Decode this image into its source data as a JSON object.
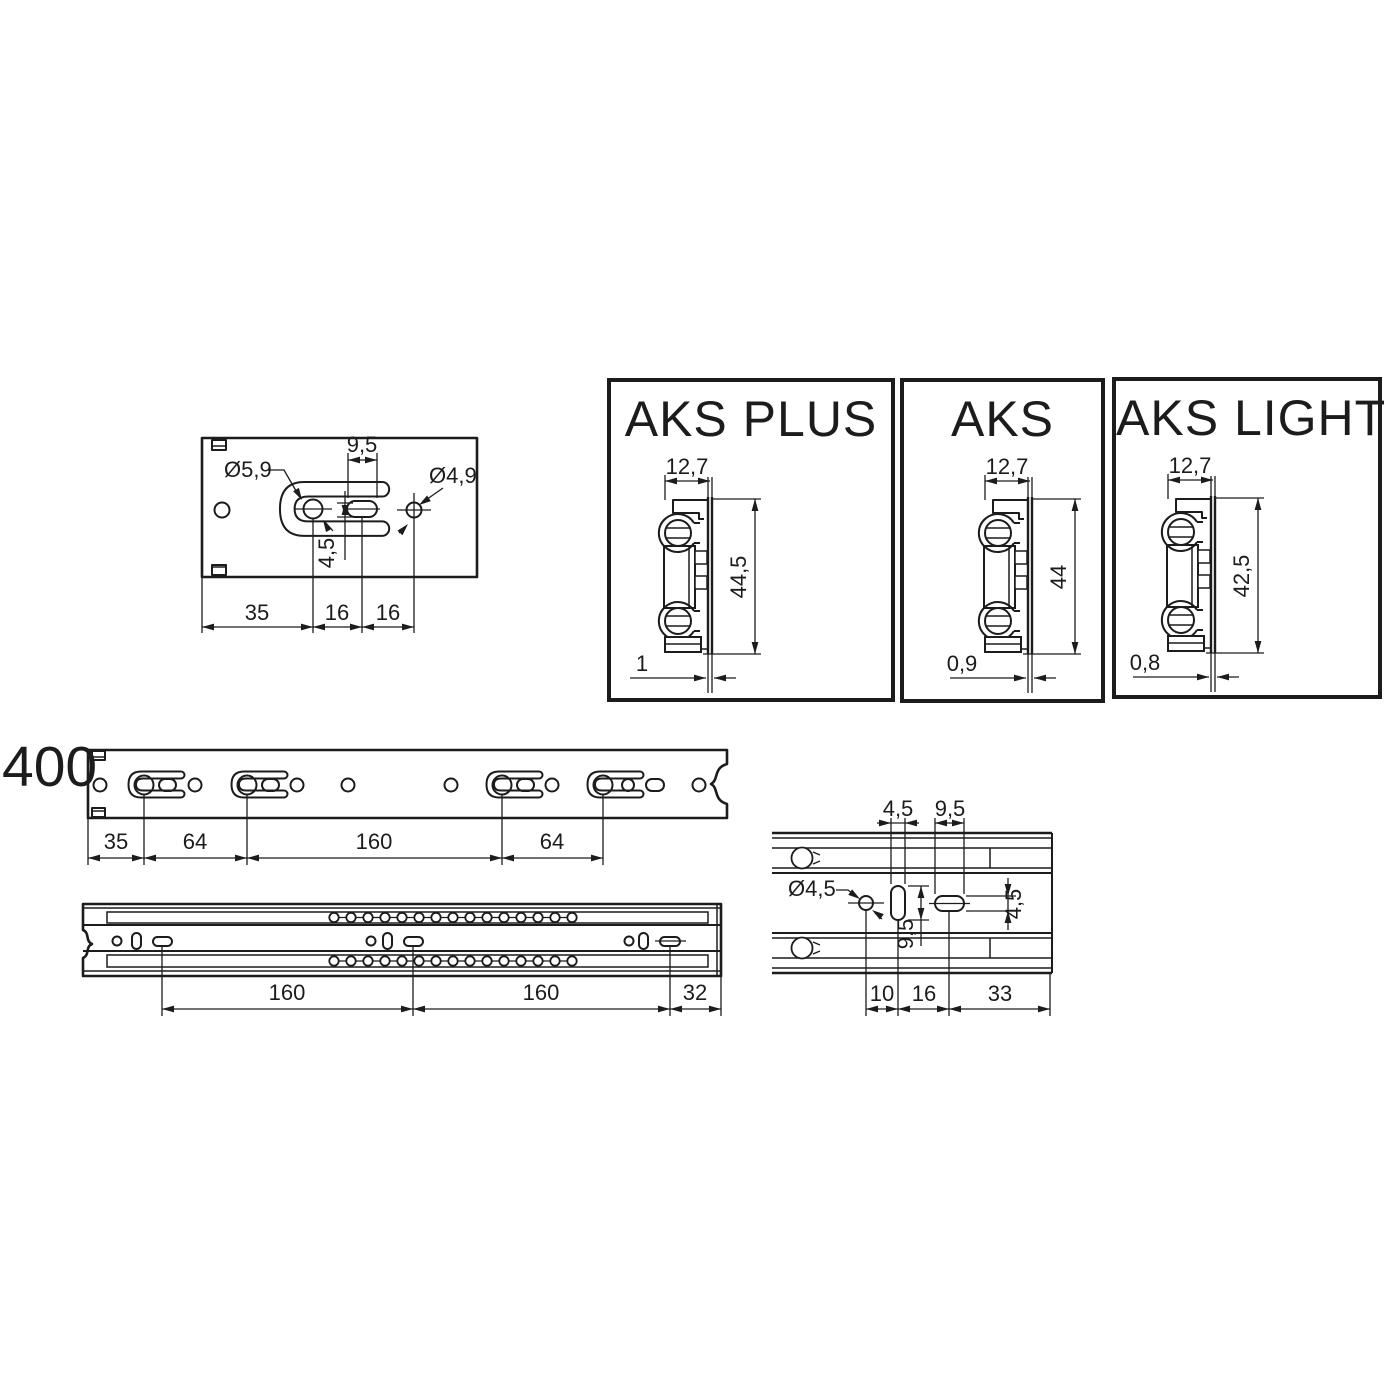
{
  "colors": {
    "background": "#ffffff",
    "ink": "#1c1c1c"
  },
  "plate_detail": {
    "slot_width": "9,5",
    "hole_left": "Ø5,9",
    "hole_right": "Ø4,9",
    "vertical_offset": "4,5",
    "bottom_dims": [
      "35",
      "16",
      "16"
    ]
  },
  "profile_cards": [
    {
      "title": "AKS PLUS",
      "width": "12,7",
      "height": "44,5",
      "wall": "1"
    },
    {
      "title": "AKS",
      "width": "12,7",
      "height": "44",
      "wall": "0,9"
    },
    {
      "title": "AKS LIGHT",
      "width": "12,7",
      "height": "42,5",
      "wall": "0,8"
    }
  ],
  "rail_length_label": "400",
  "cabinet_rail": {
    "bottom_dims": [
      "35",
      "64",
      "160",
      "64"
    ]
  },
  "assembled_rail": {
    "bottom_dims": [
      "160",
      "160",
      "32"
    ]
  },
  "end_detail": {
    "top_dims": [
      "4,5",
      "9,5"
    ],
    "hole": "Ø4,5",
    "slot_length": "9,5",
    "slot_height": "4,5",
    "bottom_dims": [
      "10",
      "16",
      "33"
    ]
  }
}
